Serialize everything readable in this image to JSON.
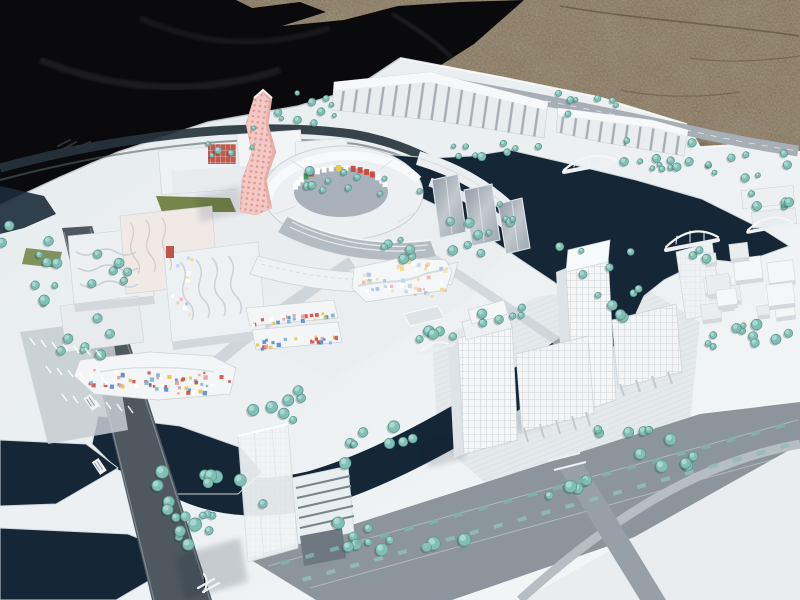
{
  "scene": {
    "description": "Photograph of a white architectural scale model of a canal-side urban district, viewed at an angle outdoors",
    "environment": {
      "ground": "brown gravel pavement (upper right)",
      "covering": "black tarp bunched at upper left",
      "board": "large white model base board seen in perspective"
    },
    "model_features": [
      "dark navy canals and basins looping through the district",
      "pink twisted high-rise with dotted facade",
      "oval courtyard building with multicoloured mosaic inner wall",
      "low-rise blocks speckled with red, yellow and blue facade tiles",
      "cluster of white office towers and slabs on south-east island",
      "translucent tower with louvered podium near bottom",
      "sawtooth-roof shed rows at the top",
      "white arch footbridges over the canals",
      "tree-lined boulevard with planted medians",
      "striped parking lots along the left road",
      "empty white plaza at bottom right"
    ],
    "marks": {
      "board_logo": "small illegible dark maker's mark on the board corner",
      "road_labels": "tiny illegible white street labels on the dark road",
      "road_symbol": "small white transit-style symbol painted on the road"
    }
  },
  "palette": {
    "gravel": "#85765f",
    "gravel_dark": "#5c5040",
    "tarp": "#0a0a0d",
    "tarp_sheen": "#2b2b31",
    "board": "#edf1f3",
    "board_shadow": "#d6dce0",
    "water": "#152636",
    "water_edge": "#cfd7db",
    "road": "#8d959c",
    "road_dark": "#4f585f",
    "road_light": "#a7aeb5",
    "tree": "#7fbfb5",
    "tree_light": "#b5ddd6",
    "tree_dark": "#57968c",
    "building": "#f4f6f7",
    "building_shade": "#d2d8dc",
    "building_dark": "#b4bcc3",
    "glass": "#98a2aa",
    "pink_tower": "#f2c9c4",
    "pink_dots": "#e08d84",
    "red_facade": "#c4584b",
    "lawn": "#75864a",
    "plaza": "#e9edf0",
    "mosaic": [
      "#d94f43",
      "#e8c84a",
      "#5b8fd6",
      "#e89f9f",
      "#79b8d4",
      "#ffffff"
    ],
    "mosaic_pastel": [
      "#f2d98a",
      "#a8c4e8",
      "#f0b8b4",
      "#f3e3b0",
      "#bfd9ee",
      "#ffffff"
    ],
    "court_mosaic": [
      "#4a7bd0",
      "#cf4a3f",
      "#3e9e5f",
      "#e8c84a",
      "#ffffff",
      "#d94f43"
    ]
  }
}
